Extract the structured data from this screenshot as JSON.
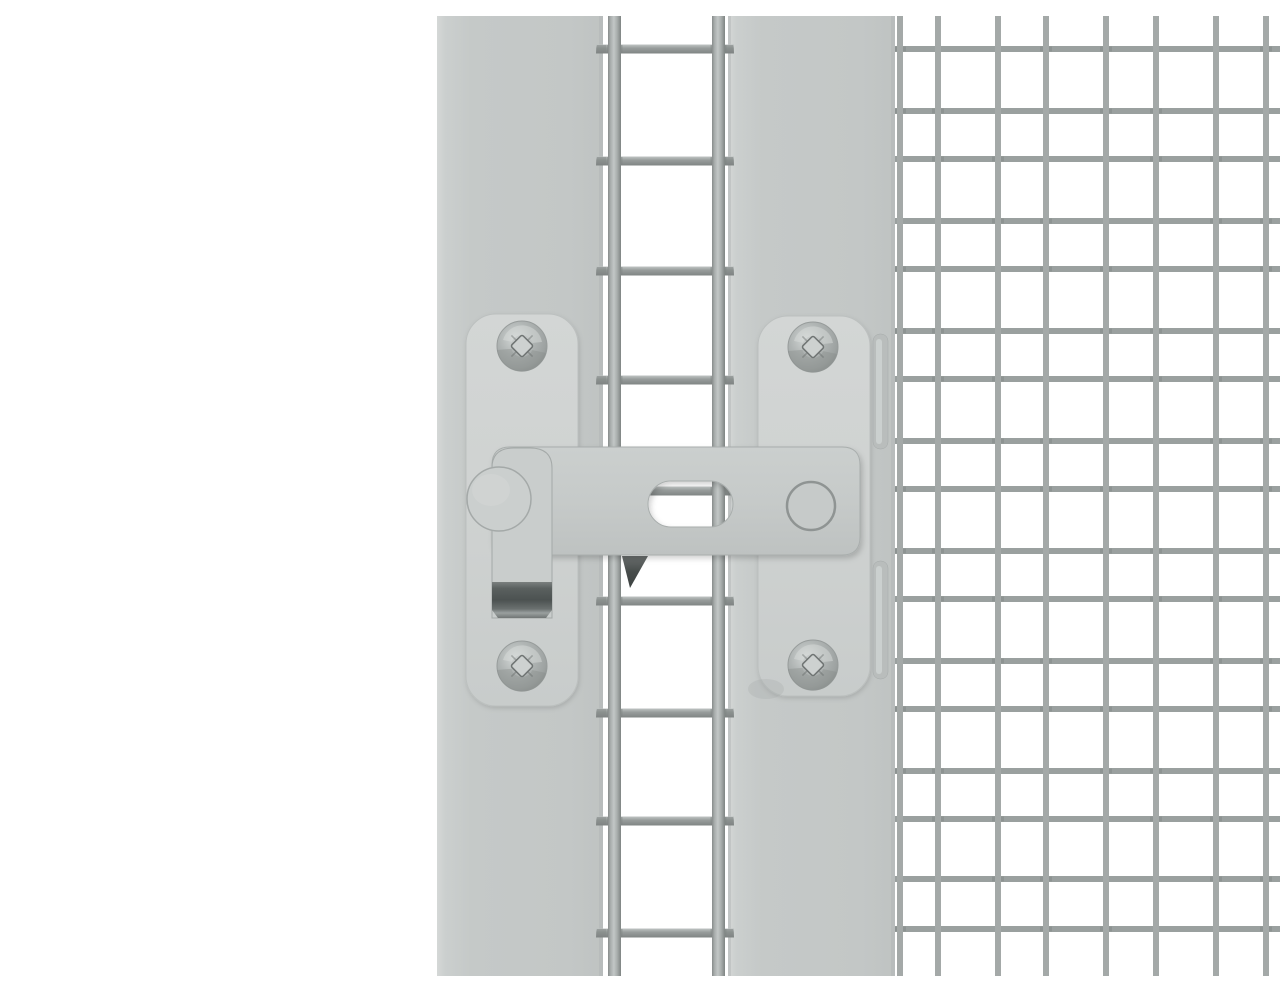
{
  "meta": {
    "alt": "Gray steel slide latch mounted across a galvanized wire mesh cage door"
  },
  "colors": {
    "background": "#ffffff",
    "post": "#c5c9c8",
    "post_light": "#d6d9d8",
    "post_dark": "#bfc3c2",
    "post_edge_dark": "#b2b6b5",
    "plate": "#cfd2d1",
    "plate_stroke": "#bcc0bf",
    "bar": "#c6cac9",
    "bar_stroke": "#a9aead",
    "knob": "#cbcfce",
    "knob_stroke": "#a4a9a8",
    "handle": "#c9cdcc",
    "tip_dark": "#4c5251",
    "tip_light": "#9aa09f",
    "wire_fine_v": "#a4a9a8",
    "wire_fine_h": "#9aa09f",
    "wire_coarse": "#a0a5a4",
    "joint": "#7e8382",
    "screw_base": "#b0b5b4",
    "screw_light": "#d5d9d8",
    "screw_dark": "#8a8f8e",
    "screw_recess": "#cdd1d0",
    "screw_recess_stroke": "#6f7473",
    "pivot_stroke": "#8f9493",
    "tab": "#b9bdbc",
    "tab_light": "#d0d4d3",
    "wedge_dark": "#3d4241"
  },
  "mesh": {
    "fine": {
      "vertical_x": [
        860,
        898,
        958,
        1006,
        1066,
        1116,
        1176,
        1226
      ],
      "horizontal_y": [
        33,
        95,
        143,
        205,
        253,
        315,
        363,
        425,
        473,
        535,
        583,
        645,
        693,
        755,
        803,
        863,
        913
      ],
      "v_extent": [
        0,
        960
      ],
      "h_extent": [
        853,
        1280
      ],
      "wire_width": 6
    },
    "coarse": {
      "vertical_x": [
        574.5,
        678.5
      ],
      "horizontal_y": [
        33,
        145,
        255,
        364,
        475,
        585,
        697,
        805,
        917
      ],
      "v_extent": [
        0,
        960
      ],
      "h_extent": [
        556,
        694
      ],
      "v_width": 13,
      "h_width": 9
    }
  },
  "latch": {
    "components": [
      "mounting-plate-left",
      "mounting-plate-right",
      "latch-bar",
      "latch-slot",
      "handle-knob",
      "handle-grip",
      "pivot-rivet",
      "pan-head-screws",
      "catch-tabs"
    ],
    "screw_count": 4
  }
}
